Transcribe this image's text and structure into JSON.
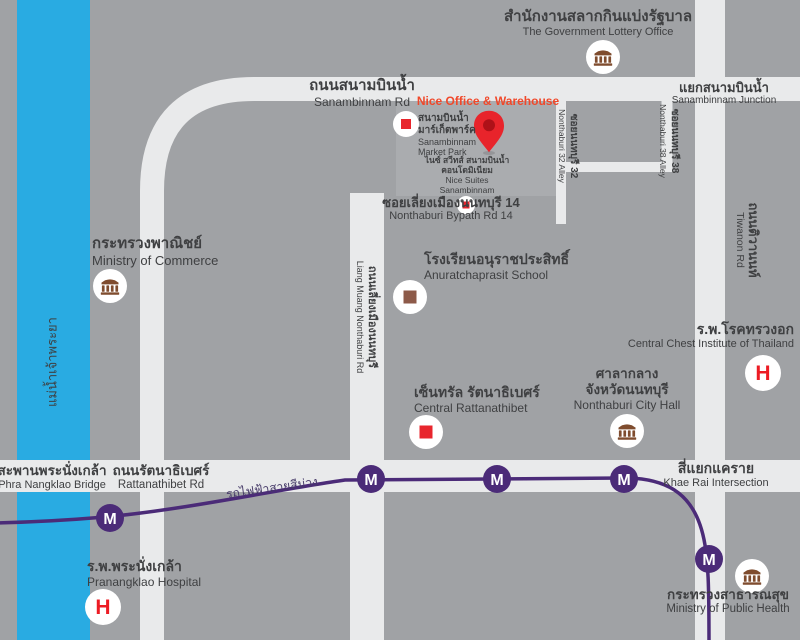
{
  "colors": {
    "background": "#a0a2a5",
    "road": "#e9eaeb",
    "river_blue": "#29abe2",
    "metro_purple": "#4b2b78",
    "text_dark": "#3f4042",
    "highlight_red": "#f0482a",
    "marker_red": "#e8262d",
    "bank_brown": "#7f4c2e",
    "school_brown": "#8d5a49",
    "block_gray": "#aaacaf"
  },
  "river": {
    "th": "แม่น้ำเจ้าพระยา"
  },
  "highlight": {
    "label": "Nice Office & Warehouse",
    "icon": "location-pin-icon"
  },
  "roads": {
    "sanambinnam": {
      "th": "ถนนสนามบินน้ำ",
      "en": "Sanambinnam Rd"
    },
    "rattanathibet": {
      "th": "ถนนรัตนาธิเบศร์",
      "en": "Rattanathibet Rd"
    },
    "tiwanon": {
      "th": "ถนนติวานนท์",
      "en": "Tiwanon Rd"
    },
    "liang_muang": {
      "th": "ถนนเลี่ยงเมืองนนทบุรี",
      "en": "Liang Muang Nonthaburi Rd"
    },
    "bypath": {
      "th": "ซอยเลี่ยงเมืองนนทบุรี 14",
      "en": "Nonthaburi Bypath Rd 14"
    },
    "soi32": {
      "th": "ซอยนนทบุรี 32",
      "en": "Nonthaburi 32 Alley"
    },
    "soi38": {
      "th": "ซอยนนทบุรี 38",
      "en": "Nonthaburi 38 Alley"
    }
  },
  "junctions": {
    "sanambinnam": {
      "th": "แยกสนามบินน้ำ",
      "en": "Sanambinnam Junction"
    },
    "khae_rai": {
      "th": "สี่แยกแคราย",
      "en": "Khae Rai Intersection"
    },
    "bridge": {
      "th": "สะพานพระนั่งเกล้า",
      "en": "Phra Nangklao Bridge"
    }
  },
  "places": {
    "lottery": {
      "th": "สำนักงานสลากกินแบ่งรัฐบาล",
      "en": "The Government Lottery Office",
      "icon": "government-building-icon"
    },
    "commerce": {
      "th": "กระทรวงพาณิชย์",
      "en": "Ministry of Commerce",
      "icon": "government-building-icon"
    },
    "market_park": {
      "th1": "สนามบินน้ำ",
      "th2": "มาร์เก็ตพาร์ค",
      "en1": "Sanambinnam",
      "en2": "Market Park",
      "icon": "mall-icon"
    },
    "nice_suites": {
      "th1": "ไนซ์ สวีทส์ สนามบินน้ำ",
      "th2": "คอนโดมิเนียม",
      "en1": "Nice Suites",
      "en2": "Sanambinnam",
      "icon": "mall-icon"
    },
    "school": {
      "th": "โรงเรียนอนุราชประสิทธิ์",
      "en": "Anuratchaprasit School",
      "icon": "school-icon"
    },
    "central": {
      "th": "เซ็นทรัล รัตนาธิเบศร์",
      "en": "Central Rattanathibet",
      "icon": "mall-icon"
    },
    "city_hall": {
      "th1": "ศาลากลาง",
      "th2": "จังหวัดนนทบุรี",
      "en": "Nonthaburi City Hall",
      "icon": "government-building-icon"
    },
    "chest": {
      "th": "ร.พ.โรคทรวงอก",
      "en": "Central Chest Institute of Thailand",
      "icon": "hospital-icon"
    },
    "pranangklao": {
      "th": "ร.พ.พระนั่งเกล้า",
      "en": "Pranangklao Hospital",
      "icon": "hospital-icon"
    },
    "moph": {
      "th": "กระทรวงสาธารณสุข",
      "en": "Ministry of Public Health",
      "icon": "government-building-icon"
    }
  },
  "metro": {
    "line_th": "รถไฟฟ้าสายสีม่วง",
    "station_letter": "M",
    "stations_count": 5
  },
  "icons": {
    "hospital_letter": "H"
  }
}
